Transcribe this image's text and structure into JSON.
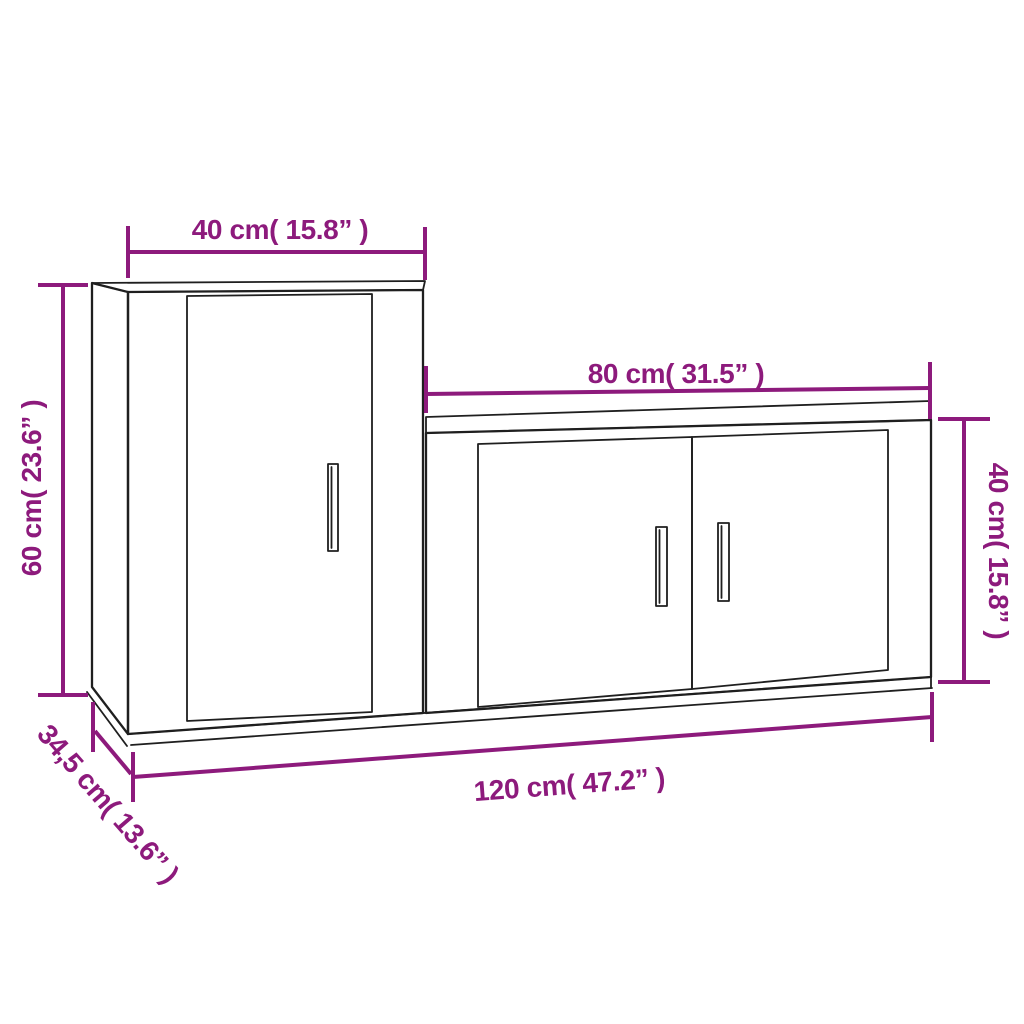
{
  "diagram": {
    "colors": {
      "dimension_accent": "#8d1a7c",
      "line": "#1f1f1f",
      "background": "#ffffff"
    },
    "labels": {
      "tall_cabinet_width": "40 cm( 15.8” )",
      "tall_cabinet_height": "60 cm( 23.6” )",
      "tall_cabinet_depth": "34,5 cm( 13.6” )",
      "low_cabinet_width": "80 cm( 31.5” )",
      "low_cabinet_height": "40 cm( 15.8” )",
      "total_width": "120 cm( 47.2” )"
    }
  }
}
